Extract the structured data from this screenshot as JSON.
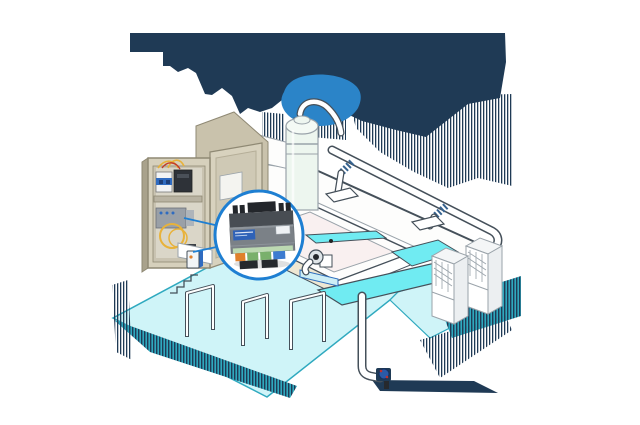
{
  "figure": {
    "aria_label": "Isometric illustration of an industrial water-treatment room: electrical control cabinet with breakers on the left, a circular blue callout magnifying a DIN-rail automation controller, cyan water basins, a scrubber tank, ventilation ducts running to two air-handling units on the right, and a drain pipe down to a small blue pump, under a dark navy banner shape with a blue cloud blob",
    "elements": [
      "top-navy-shape",
      "cloud-shape",
      "stripe-shadows",
      "electrical-cabinet",
      "cabinet-door",
      "circuit-breaker",
      "contactor",
      "overload-relay",
      "wire-loop",
      "wall-sensor",
      "stairs",
      "callout-circle",
      "leader-lines",
      "din-rail-controller",
      "controller-terminal-blocks",
      "scrubber-tank",
      "exhaust-duct",
      "duct-branch-1",
      "duct-branch-2",
      "air-handling-unit-1",
      "air-handling-unit-2",
      "floor-slab",
      "water-basin",
      "water-band",
      "door-frames",
      "center-pump",
      "drain-pipe",
      "bottom-pump"
    ]
  },
  "colors": {
    "navy": "#1f3a55",
    "sky_blue": "#2b84c8",
    "callout_blue": "#1e7fd2",
    "floor_cyan": "#cff4f8",
    "water_cyan": "#70ebf2",
    "teal_edge": "#2fa9bf",
    "outline_dark": "#45505a",
    "outline_light": "#9aa3aa",
    "cabinet_beige": "#d6d0bc",
    "cabinet_shade": "#a9a28c",
    "cabinet_dark": "#8f8974",
    "breaker_blue": "#2f6bc0",
    "wire_orange": "#e8b23a",
    "wire_red": "#c23b2a",
    "device_gray": "#7b8187",
    "device_dark": "#484d53",
    "label_blue": "#2f62b8",
    "terminal_green": "#79b06c",
    "terminal_mint": "#bcd9b2",
    "terminal_orange": "#e0802a",
    "terminal_blue": "#3d7cd0",
    "pump_blue": "#2b5aa8",
    "pump_red": "#c03030",
    "tank_tint": "#edf6ef",
    "basin_pink": "#f9f0f0",
    "basin_beige": "#eee7d3"
  }
}
